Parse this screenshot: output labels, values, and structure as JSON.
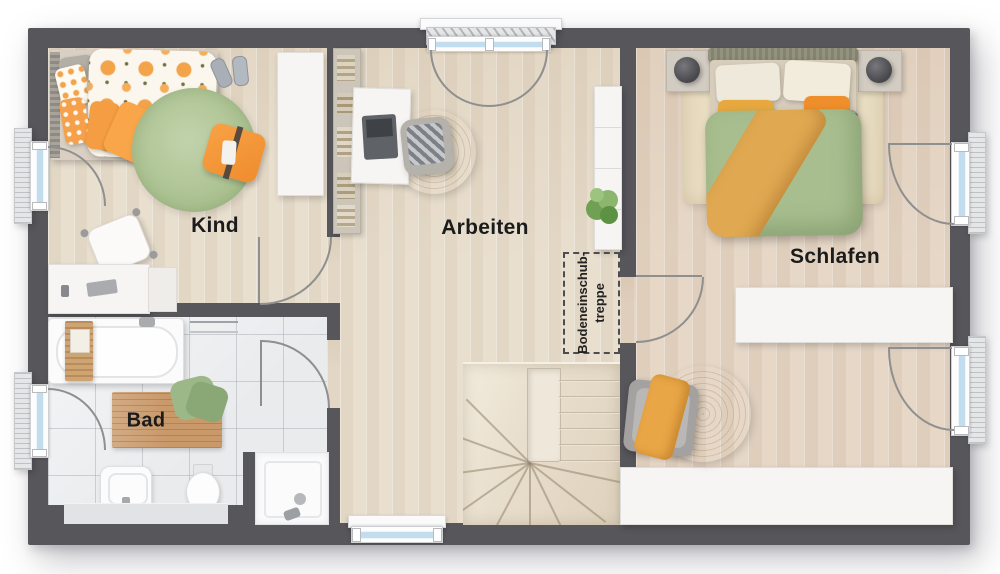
{
  "floorplan": {
    "rooms": [
      {
        "id": "kind",
        "label": "Kind"
      },
      {
        "id": "arbeiten",
        "label": "Arbeiten"
      },
      {
        "id": "schlafen",
        "label": "Schlafen"
      },
      {
        "id": "bad",
        "label": "Bad"
      }
    ],
    "annotations": {
      "attic_hatch_line1": "Bodeneinschub-",
      "attic_hatch_line2": "treppe"
    },
    "colors": {
      "wall": "#57565b",
      "wood_floor": "#e9dfcf",
      "wood_floor_warm": "#e6d7c7",
      "tile_floor": "#e9ebed",
      "stair_wood": "#ece4d5",
      "accent_orange": "#f49d42",
      "duvet_green": "#a8be8f",
      "rug_green": "#aac08f",
      "jute": "#d7bf95",
      "window_glass": "#c2ddee",
      "swing_arc": "#8f8f8f",
      "label_text": "#1b1b1b"
    }
  }
}
